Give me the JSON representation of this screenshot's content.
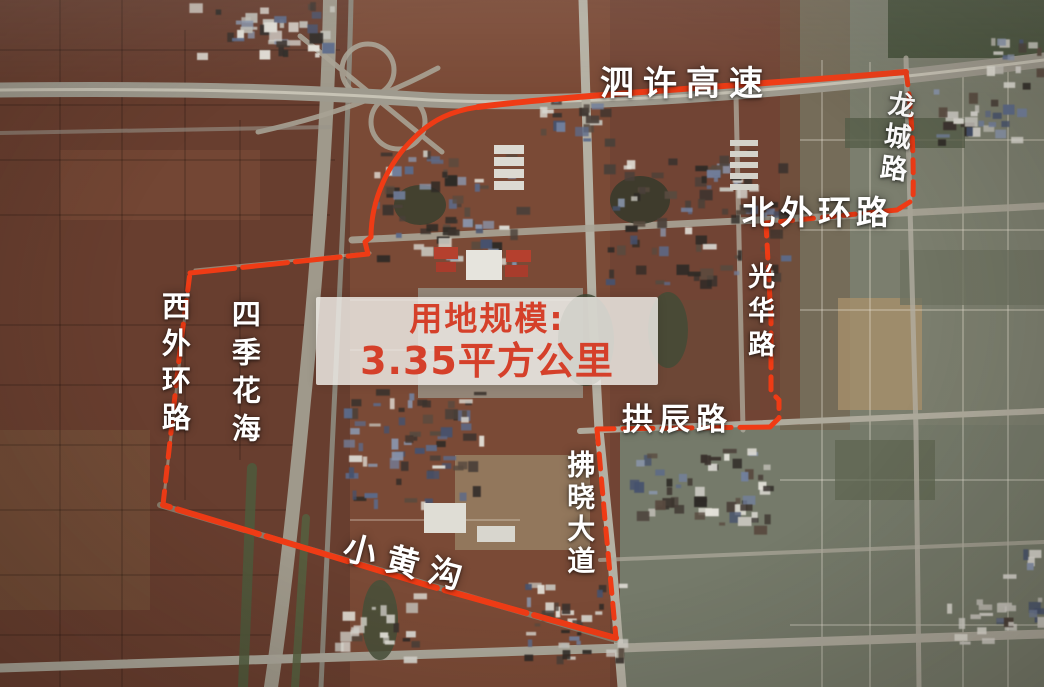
{
  "map": {
    "center_label": {
      "line1": "用地规模:",
      "line2": "3.35平方公里"
    },
    "road_labels": [
      {
        "id": "sixu-expressway",
        "text": "泗许高速",
        "orientation": "horizontal"
      },
      {
        "id": "longcheng-road",
        "text": "龙城路",
        "orientation": "vertical"
      },
      {
        "id": "north-outer-ring-road",
        "text": "北外环路",
        "orientation": "horizontal"
      },
      {
        "id": "guanghua-road",
        "text": "光华路",
        "orientation": "vertical"
      },
      {
        "id": "gongchen-road",
        "text": "拱辰路",
        "orientation": "horizontal"
      },
      {
        "id": "fuxiao-avenue",
        "text": "拂晓大道",
        "orientation": "vertical"
      },
      {
        "id": "xiaohuanggou",
        "text": "小黄沟",
        "orientation": "diagonal"
      },
      {
        "id": "west-outer-ring-road",
        "text": "西外环路",
        "orientation": "vertical"
      },
      {
        "id": "four-seasons-flower-sea",
        "text": "四季花海",
        "orientation": "vertical"
      }
    ],
    "colors": {
      "boundary_line": "#ef3b15",
      "road_label_text": "#ffffff",
      "center_label_text": "#d5402a",
      "center_label_bg": "rgba(237,235,230,0.84)"
    }
  }
}
